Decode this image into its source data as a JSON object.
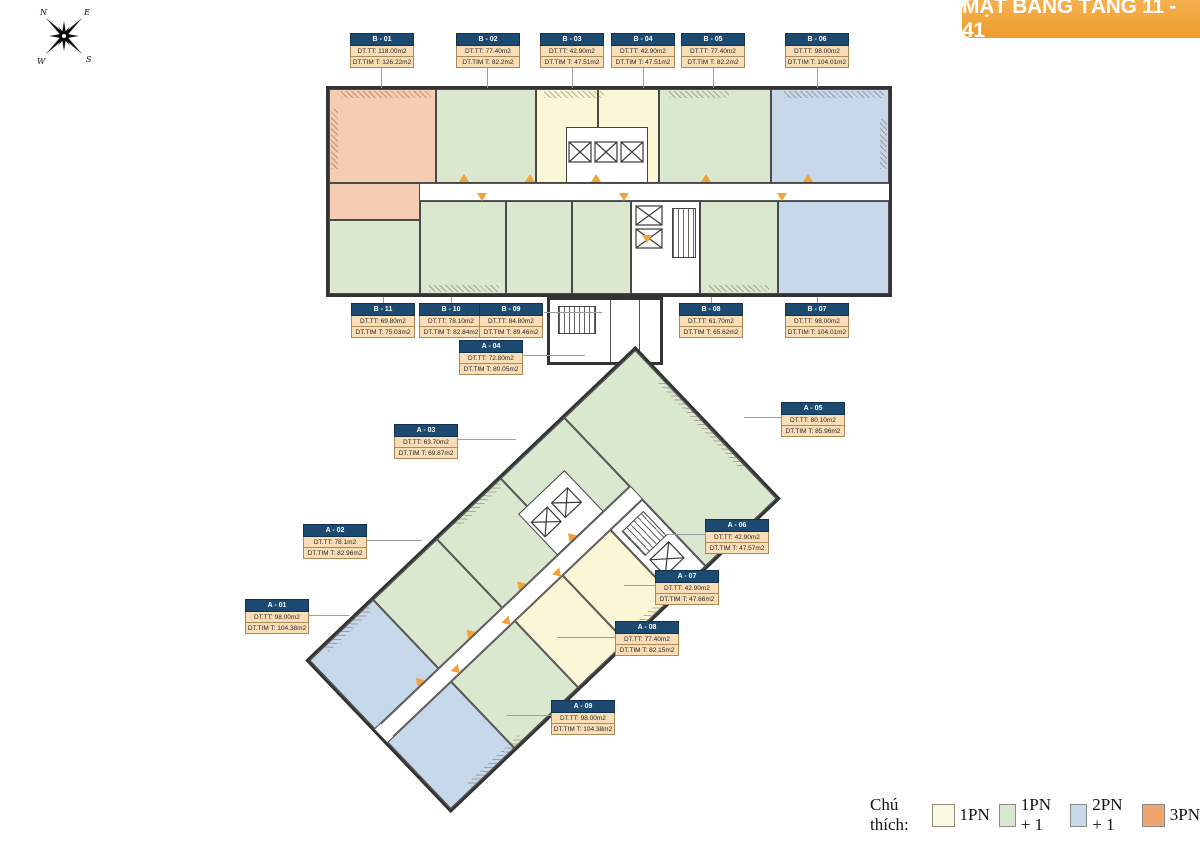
{
  "title": "MẶT BẰNG TẦNG 11 - 41",
  "compass": {
    "n": "N",
    "e": "E",
    "s": "S",
    "w": "W"
  },
  "legend": {
    "label": "Chú thích:",
    "items": [
      {
        "name": "1PN",
        "color": "#FBF9DC"
      },
      {
        "name": "1PN + 1",
        "color": "#D8E7CE"
      },
      {
        "name": "2PN + 1",
        "color": "#C7D9EB"
      },
      {
        "name": "3PN",
        "color": "#F0A470"
      }
    ]
  },
  "colors": {
    "banner": "#F2A33F",
    "label_header": "#1D4A70",
    "label_row": "#F8DDB6",
    "corridor_marker": "#F2A237"
  },
  "units": [
    {
      "id": "B - 01",
      "dt_tt": "DT.TT: 118.00m2",
      "dt_tim": "DT.TIM T: 126.22m2"
    },
    {
      "id": "B - 02",
      "dt_tt": "DT.TT: 77.40m2",
      "dt_tim": "DT.TIM T: 82.2m2"
    },
    {
      "id": "B - 03",
      "dt_tt": "DT.TT: 42.90m2",
      "dt_tim": "DT.TIM T: 47.51m2"
    },
    {
      "id": "B - 04",
      "dt_tt": "DT.TT: 42.90m2",
      "dt_tim": "DT.TIM T: 47.51m2"
    },
    {
      "id": "B - 05",
      "dt_tt": "DT.TT: 77.40m2",
      "dt_tim": "DT.TIM T: 82.2m2"
    },
    {
      "id": "B - 06",
      "dt_tt": "DT.TT: 98.00m2",
      "dt_tim": "DT.TIM T: 104.01m2"
    },
    {
      "id": "B - 07",
      "dt_tt": "DT.TT: 98.00m2",
      "dt_tim": "DT.TIM T: 104.01m2"
    },
    {
      "id": "B - 08",
      "dt_tt": "DT.TT: 61.70m2",
      "dt_tim": "DT.TIM T: 65.62m2"
    },
    {
      "id": "B - 09",
      "dt_tt": "DT.TT: 84.80m2",
      "dt_tim": "DT.TIM T: 89.46m2"
    },
    {
      "id": "B - 10",
      "dt_tt": "DT.TT: 78.10m2",
      "dt_tim": "DT.TIM T: 82.84m2"
    },
    {
      "id": "B - 11",
      "dt_tt": "DT.TT: 69.80m2",
      "dt_tim": "DT.TIM T: 75.03m2"
    },
    {
      "id": "A - 01",
      "dt_tt": "DT.TT: 98.00m2",
      "dt_tim": "DT.TIM T: 104.38m2"
    },
    {
      "id": "A - 02",
      "dt_tt": "DT.TT: 78.1m2",
      "dt_tim": "DT.TIM T: 82.96m2"
    },
    {
      "id": "A - 03",
      "dt_tt": "DT.TT: 63.70m2",
      "dt_tim": "DT.TIM T: 69.87m2"
    },
    {
      "id": "A - 04",
      "dt_tt": "DT.TT: 72.80m2",
      "dt_tim": "DT.TIM T: 80.05m2"
    },
    {
      "id": "A - 05",
      "dt_tt": "DT.TT: 80.10m2",
      "dt_tim": "DT.TIM T: 85.96m2"
    },
    {
      "id": "A - 06",
      "dt_tt": "DT.TT: 42.90m2",
      "dt_tim": "DT.TIM T: 47.57m2"
    },
    {
      "id": "A - 07",
      "dt_tt": "DT.TT: 42.90m2",
      "dt_tim": "DT.TIM T: 47.66m2"
    },
    {
      "id": "A - 08",
      "dt_tt": "DT.TT: 77.40m2",
      "dt_tim": "DT.TIM T: 82.15m2"
    },
    {
      "id": "A - 09",
      "dt_tt": "DT.TT: 98.00m2",
      "dt_tim": "DT.TIM T: 104.38m2"
    }
  ]
}
